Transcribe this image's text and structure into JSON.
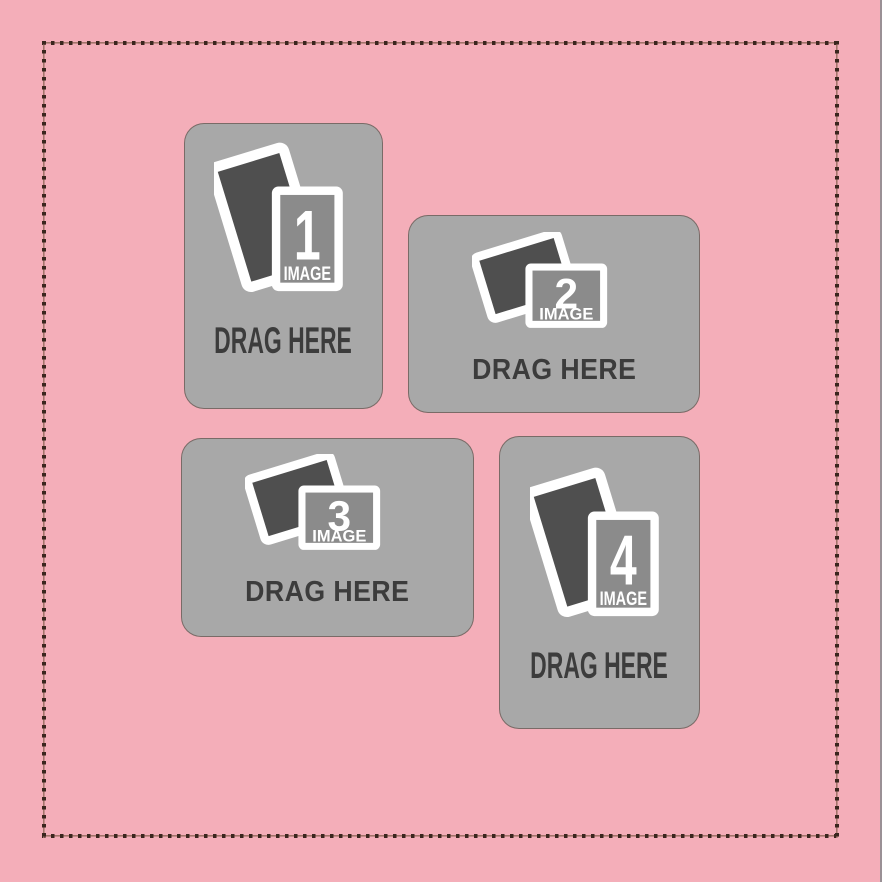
{
  "colors": {
    "canvas_background": "#f4aeb9",
    "stitch_dot": "#3a261e",
    "stitch_line": "#a3746a",
    "card_background": "#a8a8a8",
    "card_outline": "#5a423c",
    "photo_back_frame": "#4f4f4f",
    "photo_front_inner": "#8b8b8b",
    "frame_border": "#ffffff",
    "label_text": "#3c3c3c",
    "icon_text": "#ffffff"
  },
  "placeholders": [
    {
      "number": "1",
      "image_label": "IMAGE",
      "drag_label": "DRAG HERE",
      "orientation": "portrait"
    },
    {
      "number": "2",
      "image_label": "IMAGE",
      "drag_label": "DRAG HERE",
      "orientation": "landscape"
    },
    {
      "number": "3",
      "image_label": "IMAGE",
      "drag_label": "DRAG HERE",
      "orientation": "landscape"
    },
    {
      "number": "4",
      "image_label": "IMAGE",
      "drag_label": "DRAG HERE",
      "orientation": "portrait"
    }
  ]
}
